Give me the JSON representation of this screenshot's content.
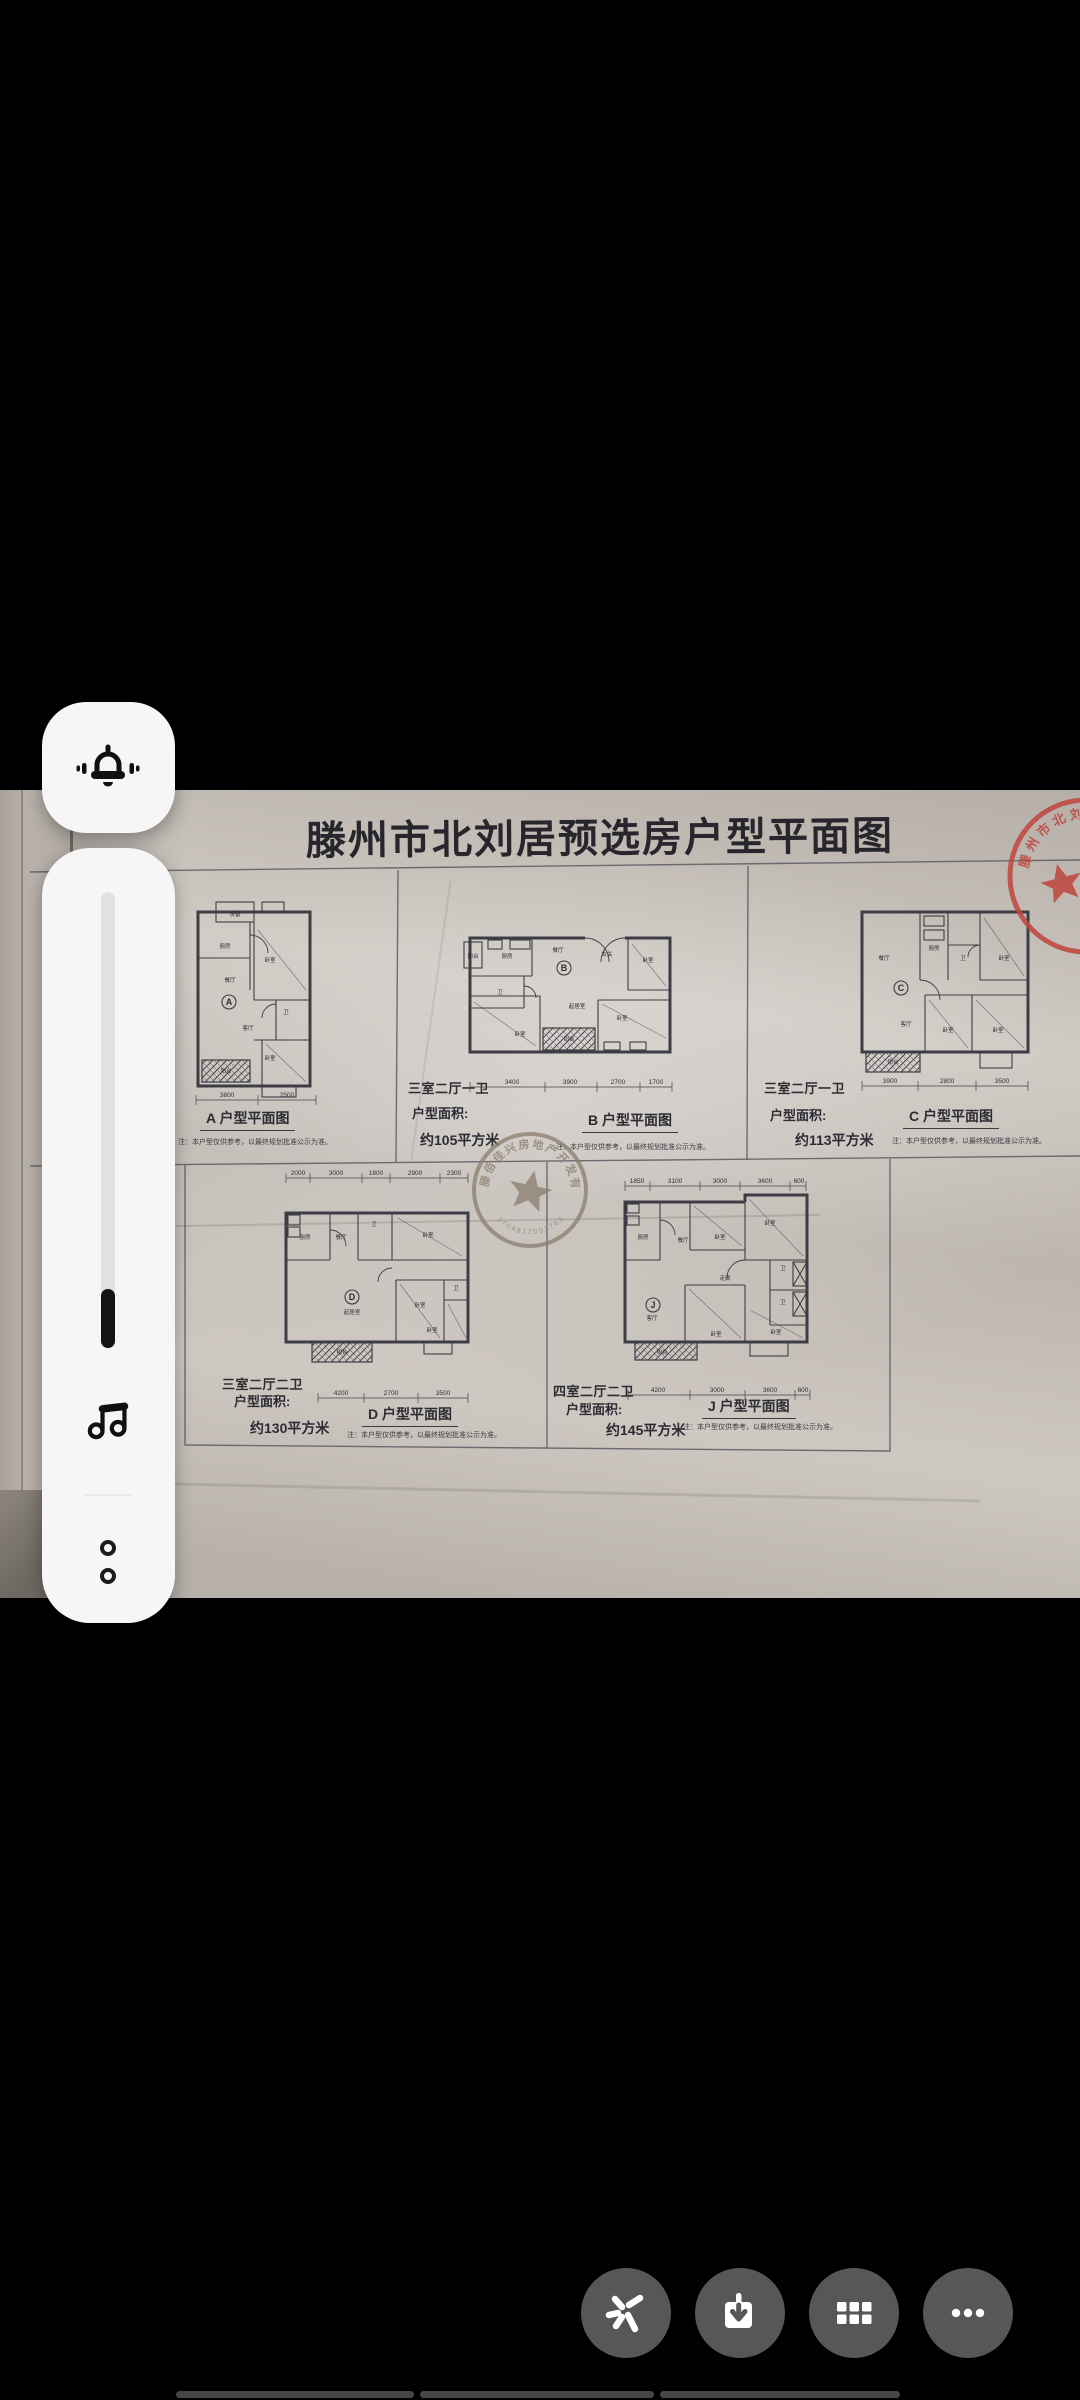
{
  "screen": {
    "background": "#000000"
  },
  "volume_panel": {
    "ring_button": {
      "icon": "bell-ring"
    },
    "slider": {
      "percent": 13,
      "track_color": "#e4e2e0",
      "fill_color": "#141414"
    },
    "media_icon": "music-note",
    "expand_icon": "two-dots"
  },
  "poster": {
    "title": "滕州市北刘居预选房户型平面图",
    "note": "注：本户型仅供参考，以最终规划批准公示为准。",
    "area_field_label": "户型面积:",
    "stamps": {
      "top_right": {
        "text": "滕州市北刘居区城改造",
        "color": "#c0453c"
      },
      "center": {
        "text": "滕佰佳兴房地产开发有限公司",
        "number": "3704812003763",
        "color": "#8b7d6f"
      }
    },
    "plans": [
      {
        "letter": "A",
        "caption": "A  户型平面图",
        "type": "",
        "area": "",
        "dims_bottom": [
          "3800",
          "2500"
        ],
        "rooms": [
          "设备",
          "厨房",
          "餐厅",
          "卧室",
          "卫",
          "客厅",
          "阳台",
          "卧室"
        ]
      },
      {
        "letter": "B",
        "caption": "B  户型平面图",
        "type": "三室二厅一卫",
        "area": "约105平方米",
        "dims_bottom": [
          "3400",
          "3900",
          "2700",
          "1700"
        ],
        "rooms": [
          "阳台",
          "厨房",
          "餐厅",
          "玄关",
          "卧室",
          "卫",
          "起居室",
          "卧室",
          "阳台",
          "卧室"
        ]
      },
      {
        "letter": "C",
        "caption": "C  户型平面图",
        "type": "三室二厅一卫",
        "area": "约113平方米",
        "dims_bottom": [
          "3900",
          "2800",
          "3500"
        ],
        "rooms": [
          "餐厅",
          "厨房",
          "卫",
          "卧室",
          "客厅",
          "卧室",
          "卧室",
          "阳台"
        ]
      },
      {
        "letter": "D",
        "caption": "D  户型平面图",
        "type": "三室二厅二卫",
        "area": "约130平方米",
        "dims_top": [
          "2000",
          "3000",
          "1800",
          "2900",
          "2300"
        ],
        "dims_bottom": [
          "4200",
          "2700",
          "3500"
        ],
        "rooms": [
          "厨房",
          "餐厅",
          "卫",
          "卧室",
          "起居室",
          "卧室",
          "卫",
          "卧室",
          "阳台"
        ]
      },
      {
        "letter": "J",
        "caption": "J 户型平面图",
        "type": "四室二厅二卫",
        "area": "约145平方米",
        "dims_top": [
          "1850",
          "3100",
          "3000",
          "3600",
          "600"
        ],
        "dims_bottom": [
          "4200",
          "3000",
          "3600",
          "600"
        ],
        "rooms": [
          "厨房",
          "餐厅",
          "卧室",
          "卧室",
          "走廊",
          "客厅",
          "卫",
          "卫",
          "卧室",
          "卧室",
          "阳台"
        ]
      }
    ]
  },
  "bottom_toolbar": {
    "button_color": "#57575a",
    "buttons": [
      {
        "icon": "ai-spark"
      },
      {
        "icon": "download"
      },
      {
        "icon": "grid"
      },
      {
        "icon": "more-ellipsis"
      }
    ]
  },
  "progress_bar": {
    "color": "#464646",
    "segments": 3
  }
}
